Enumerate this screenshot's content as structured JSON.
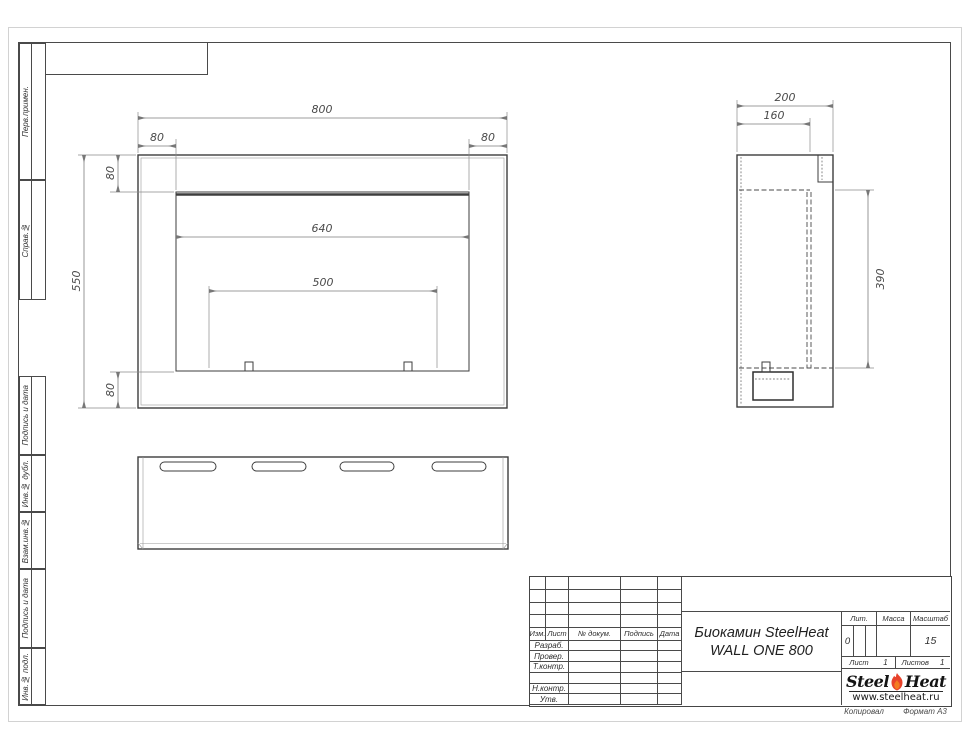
{
  "sheet": {
    "sidebar_items": [
      {
        "label": "Перв.примен."
      },
      {
        "label": "Справ.№"
      },
      {
        "label": "Подпись и дата"
      },
      {
        "label": "Инв.№ дубл."
      },
      {
        "label": "Взам.инв.№"
      },
      {
        "label": "Подпись и дата"
      },
      {
        "label": "Инв.№ подл."
      }
    ],
    "footer": {
      "copied": "Копировал",
      "format": "Формат А3"
    }
  },
  "dims": {
    "front_total_width": "800",
    "front_left_offset": "80",
    "front_right_offset": "80",
    "front_top_offset": "80",
    "front_bottom_offset": "80",
    "front_height": "550",
    "opening_width": "640",
    "burner_width": "500",
    "side_depth": "200",
    "side_inner_depth": "160",
    "side_opening_height": "390"
  },
  "title_block": {
    "header_cols": [
      "Изм.",
      "Лист",
      "№ докум.",
      "Подпись",
      "Дата"
    ],
    "row_labels": [
      "Разраб.",
      "Провер.",
      "Т.контр.",
      " ",
      "Н.контр.",
      "Утв."
    ],
    "title_line1": "Биокамин SteelHeat",
    "title_line2": "WALL ONE 800",
    "lit_label": "Лит.",
    "lit_value": "0",
    "mass_label": "Масса",
    "scale_label": "Масштаб",
    "scale_value": "15",
    "sheet_label": "Лист",
    "sheet_value": "1",
    "sheets_label": "Листов",
    "sheets_value": "1",
    "logo_steel": "Steel",
    "logo_heat": "Heat",
    "logo_url": "www.steelheat.ru",
    "logo_flame_color": "#e8432b"
  }
}
